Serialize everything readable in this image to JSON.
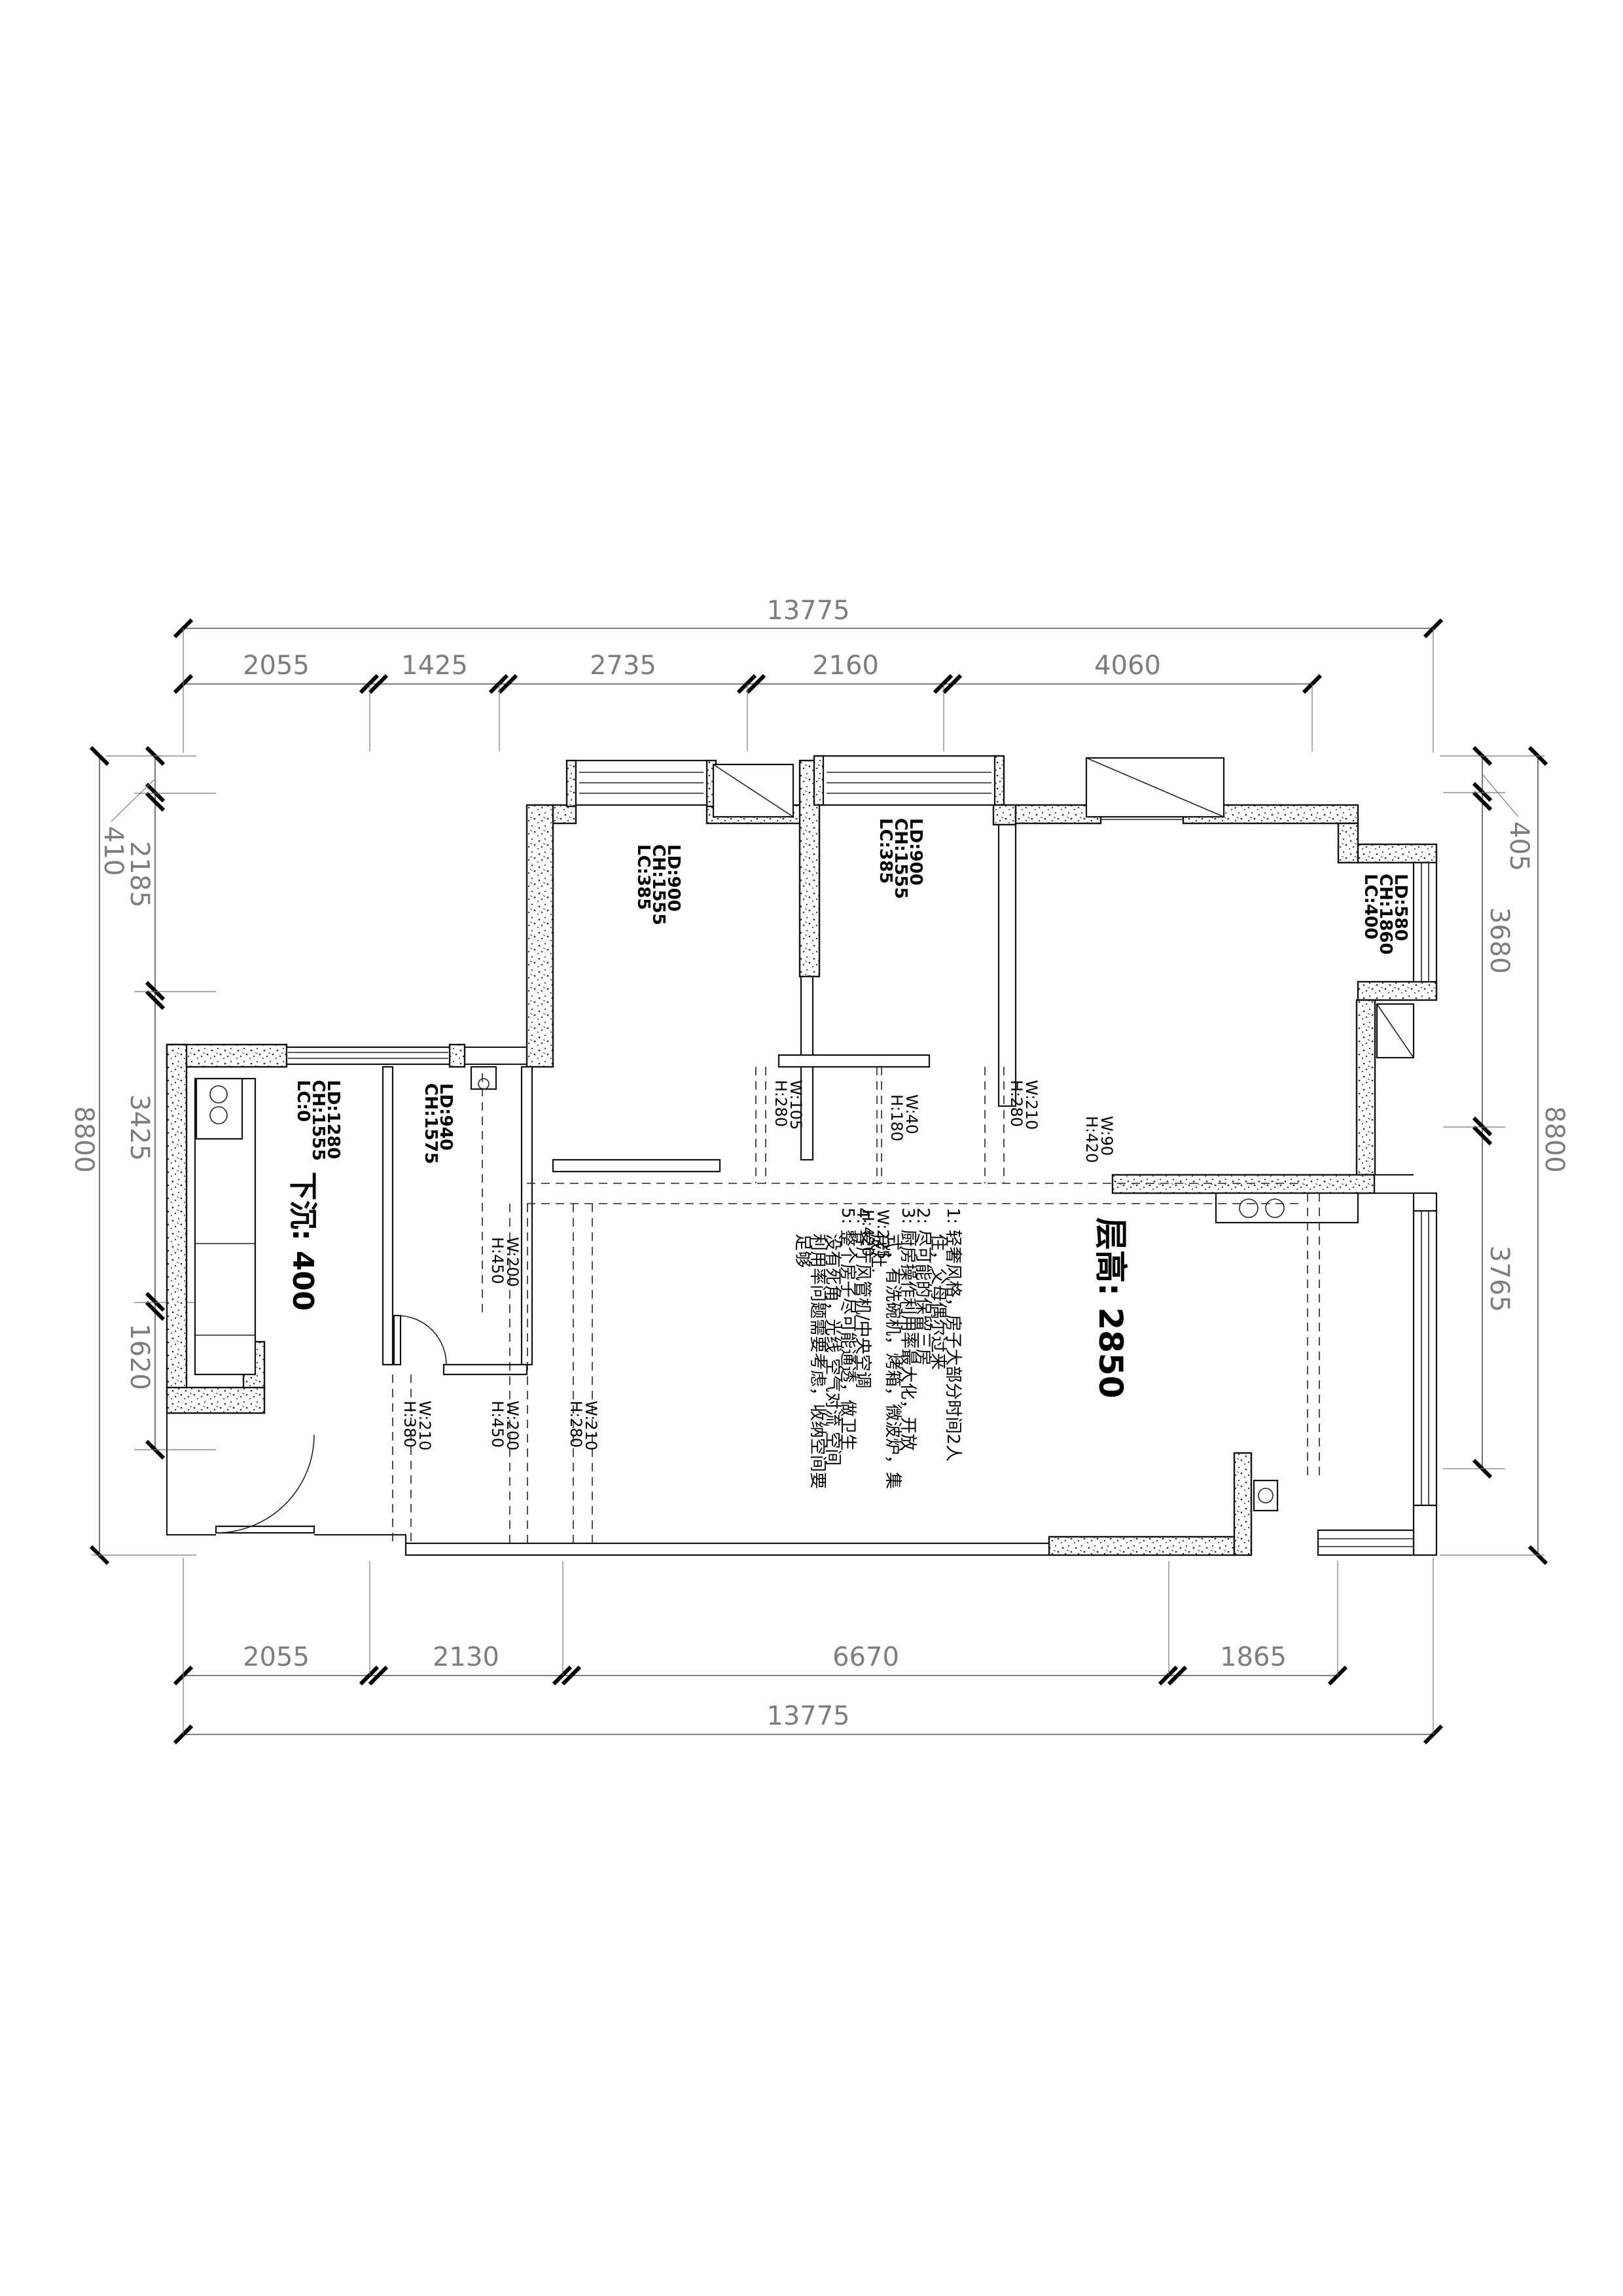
{
  "dims": {
    "top": {
      "total": "13775",
      "segments": [
        "2055",
        "1425",
        "2735",
        "2160",
        "4060"
      ]
    },
    "bottom": {
      "total": "13775",
      "segments": [
        "2055",
        "2130",
        "6670",
        "1865"
      ]
    },
    "left": {
      "total": "8800",
      "segments": [
        "410",
        "2185",
        "3425",
        "1620"
      ]
    },
    "right": {
      "total": "8800",
      "segments": [
        "405",
        "3680",
        "3765"
      ]
    }
  },
  "windows": {
    "bedroom1": [
      "LC:385",
      "CH:1555",
      "LD:900"
    ],
    "study": [
      "LC:385",
      "CH:1555",
      "LD:900"
    ],
    "right_bedroom": [
      "LC:400",
      "CH:1860",
      "LD:580"
    ],
    "kitchen": [
      "LC:0",
      "CH:1555",
      "LD:1280"
    ],
    "pantry": [
      "CH:1575",
      "LD:940"
    ]
  },
  "beams": [
    {
      "h": "H:280",
      "w": "W:105"
    },
    {
      "h": "H:180",
      "w": "W:40"
    },
    {
      "h": "H:280",
      "w": "W:210"
    },
    {
      "h": "H:420",
      "w": "W:90"
    },
    {
      "h": "H:420",
      "w": "W:225"
    },
    {
      "h": "H:450",
      "w": "W:200"
    },
    {
      "h": "H:380",
      "w": "W:210"
    },
    {
      "h": "H:450",
      "w": "W:200"
    },
    {
      "h": "H:280",
      "w": "W:210"
    }
  ],
  "texts": {
    "floor_height": "层高: 2850",
    "sunken": "下沉: 400"
  },
  "notes": [
    "1: 轻奢风格，房子大部分时间2人",
    "住，父母偶尔过来",
    "2: 尽可能的保留三房",
    "3: 厨房操作利用率最大化，开放",
    "式，有洗碗机，烤箱，微波炉，集",
    "成灶.",
    "4: 客厅风管机/中央空调",
    "5: 整个房子尽可能通透，做卫生",
    "没有死角，光线 空气对流 空间",
    "利用率问题需要考虑，收纳空间要",
    "足够"
  ]
}
